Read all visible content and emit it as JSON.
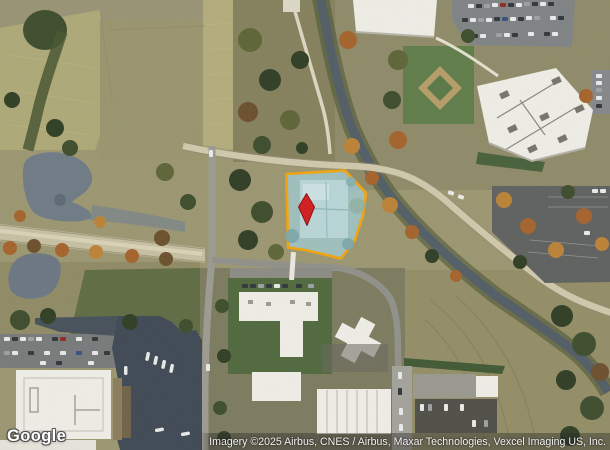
{
  "map": {
    "kind": "satellite-imagery",
    "parcel": {
      "label": "highlighted parcel",
      "border_color": "#f2a30b",
      "fill_color": "#9fc8cd"
    },
    "marker": {
      "label": "location marker",
      "color": "#d21b1f"
    }
  },
  "branding": {
    "logo_text": "Google"
  },
  "attribution": {
    "text": "Imagery ©2025 Airbus, CNES / Airbus, Maxar Technologies, Vexcel Imaging US, Inc."
  }
}
